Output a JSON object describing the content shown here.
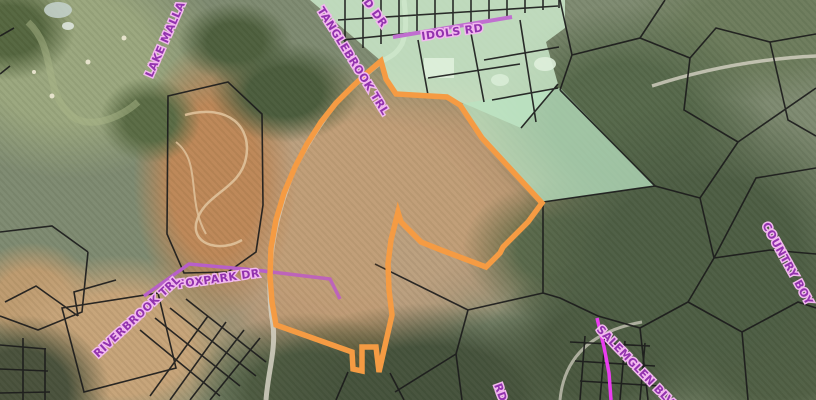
{
  "map": {
    "type": "county-gis-parcel-map-on-aerial-imagery",
    "road_labels": [
      {
        "id": "lake-malla",
        "text": "LAKE MALLA"
      },
      {
        "id": "d-dr-partial",
        "text": "D DR"
      },
      {
        "id": "tanglebrook-trl",
        "text": "TANGLEBROOK TRL"
      },
      {
        "id": "idols-rd",
        "text": "IDOLS RD"
      },
      {
        "id": "foxpark-dr",
        "text": "FOXPARK DR"
      },
      {
        "id": "riverbrook-trl",
        "text": "RIVERBROOK TRL"
      },
      {
        "id": "country-boy",
        "text": "COUNTRY BOY"
      },
      {
        "id": "salemglen-blvd",
        "text": "SALEMGLEN BLVD"
      },
      {
        "id": "rd-partial",
        "text": "RD"
      }
    ],
    "highlighted_parcel": {
      "outline_color": "#F59B43"
    },
    "colors": {
      "road_label_fill": "#9232AE",
      "road_label_halo": "#F2B8EF",
      "road_line_purple": "#C06FD0",
      "road_line_magenta": "#EA3DF0",
      "parcel_boundary_black": "#1C1C1C",
      "greenspace_overlay": "#CDECCD"
    }
  }
}
